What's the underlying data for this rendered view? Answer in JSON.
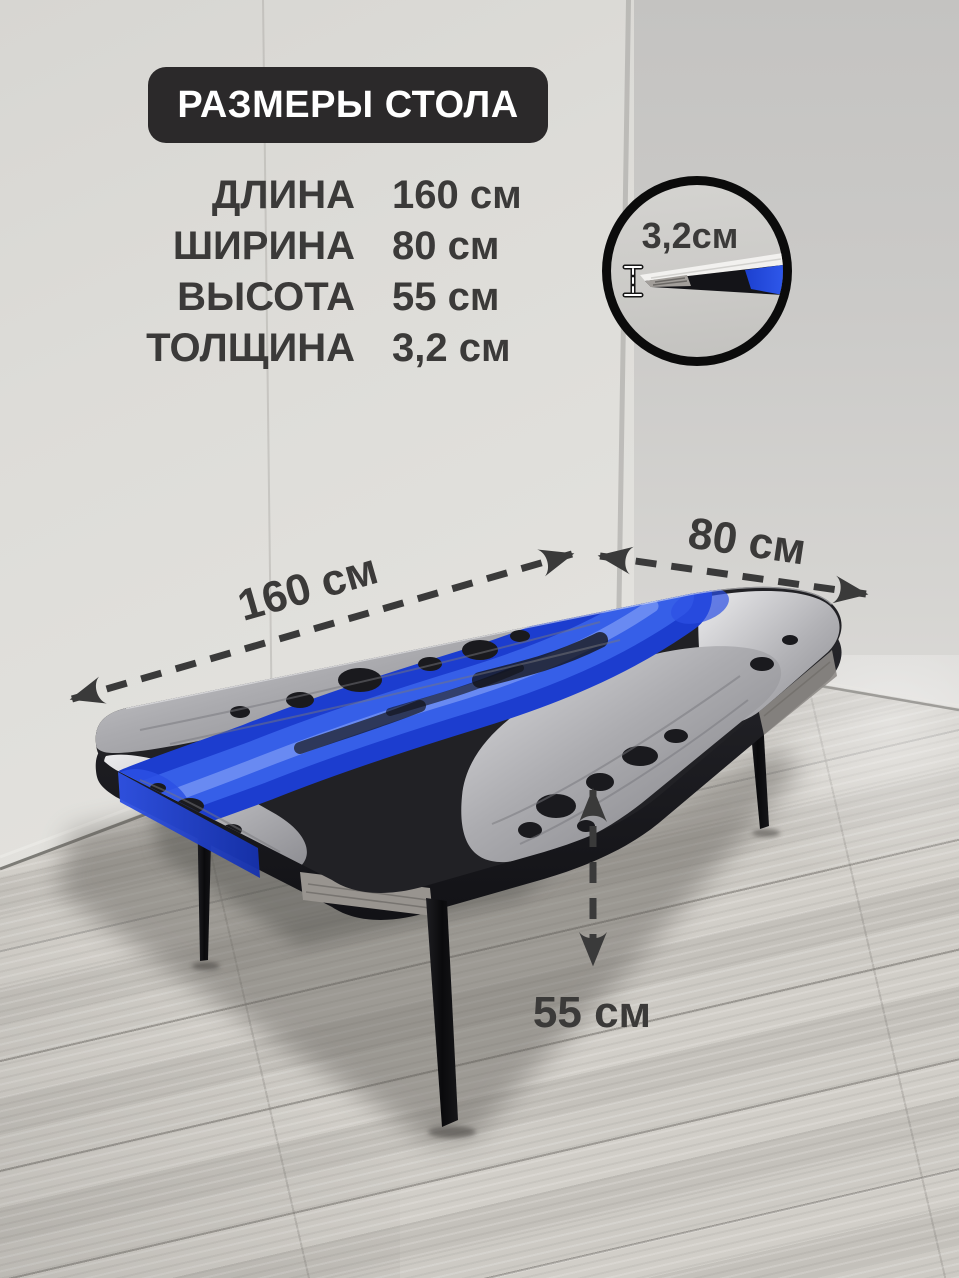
{
  "title": "РАЗМЕРЫ СТОЛА",
  "spec_rows": [
    {
      "label": "ДЛИНА",
      "value": "160 см"
    },
    {
      "label": "ШИРИНА",
      "value": "80 см"
    },
    {
      "label": "ВЫСОТА",
      "value": "55 см"
    },
    {
      "label": "ТОЛЩИНА",
      "value": "3,2 см"
    }
  ],
  "photo_annotations": {
    "length": "160 см",
    "width": "80 см",
    "height": "55 см",
    "thickness_inset": "3,2см"
  },
  "colors": {
    "title_bg": "#2b292a",
    "text": "#3b3a39",
    "arrow": "#3a3a3a",
    "river_blue": "#2140d4",
    "wall_left": "#deddda",
    "wall_right": "#cbcac8",
    "floor": "#c7c4be"
  }
}
